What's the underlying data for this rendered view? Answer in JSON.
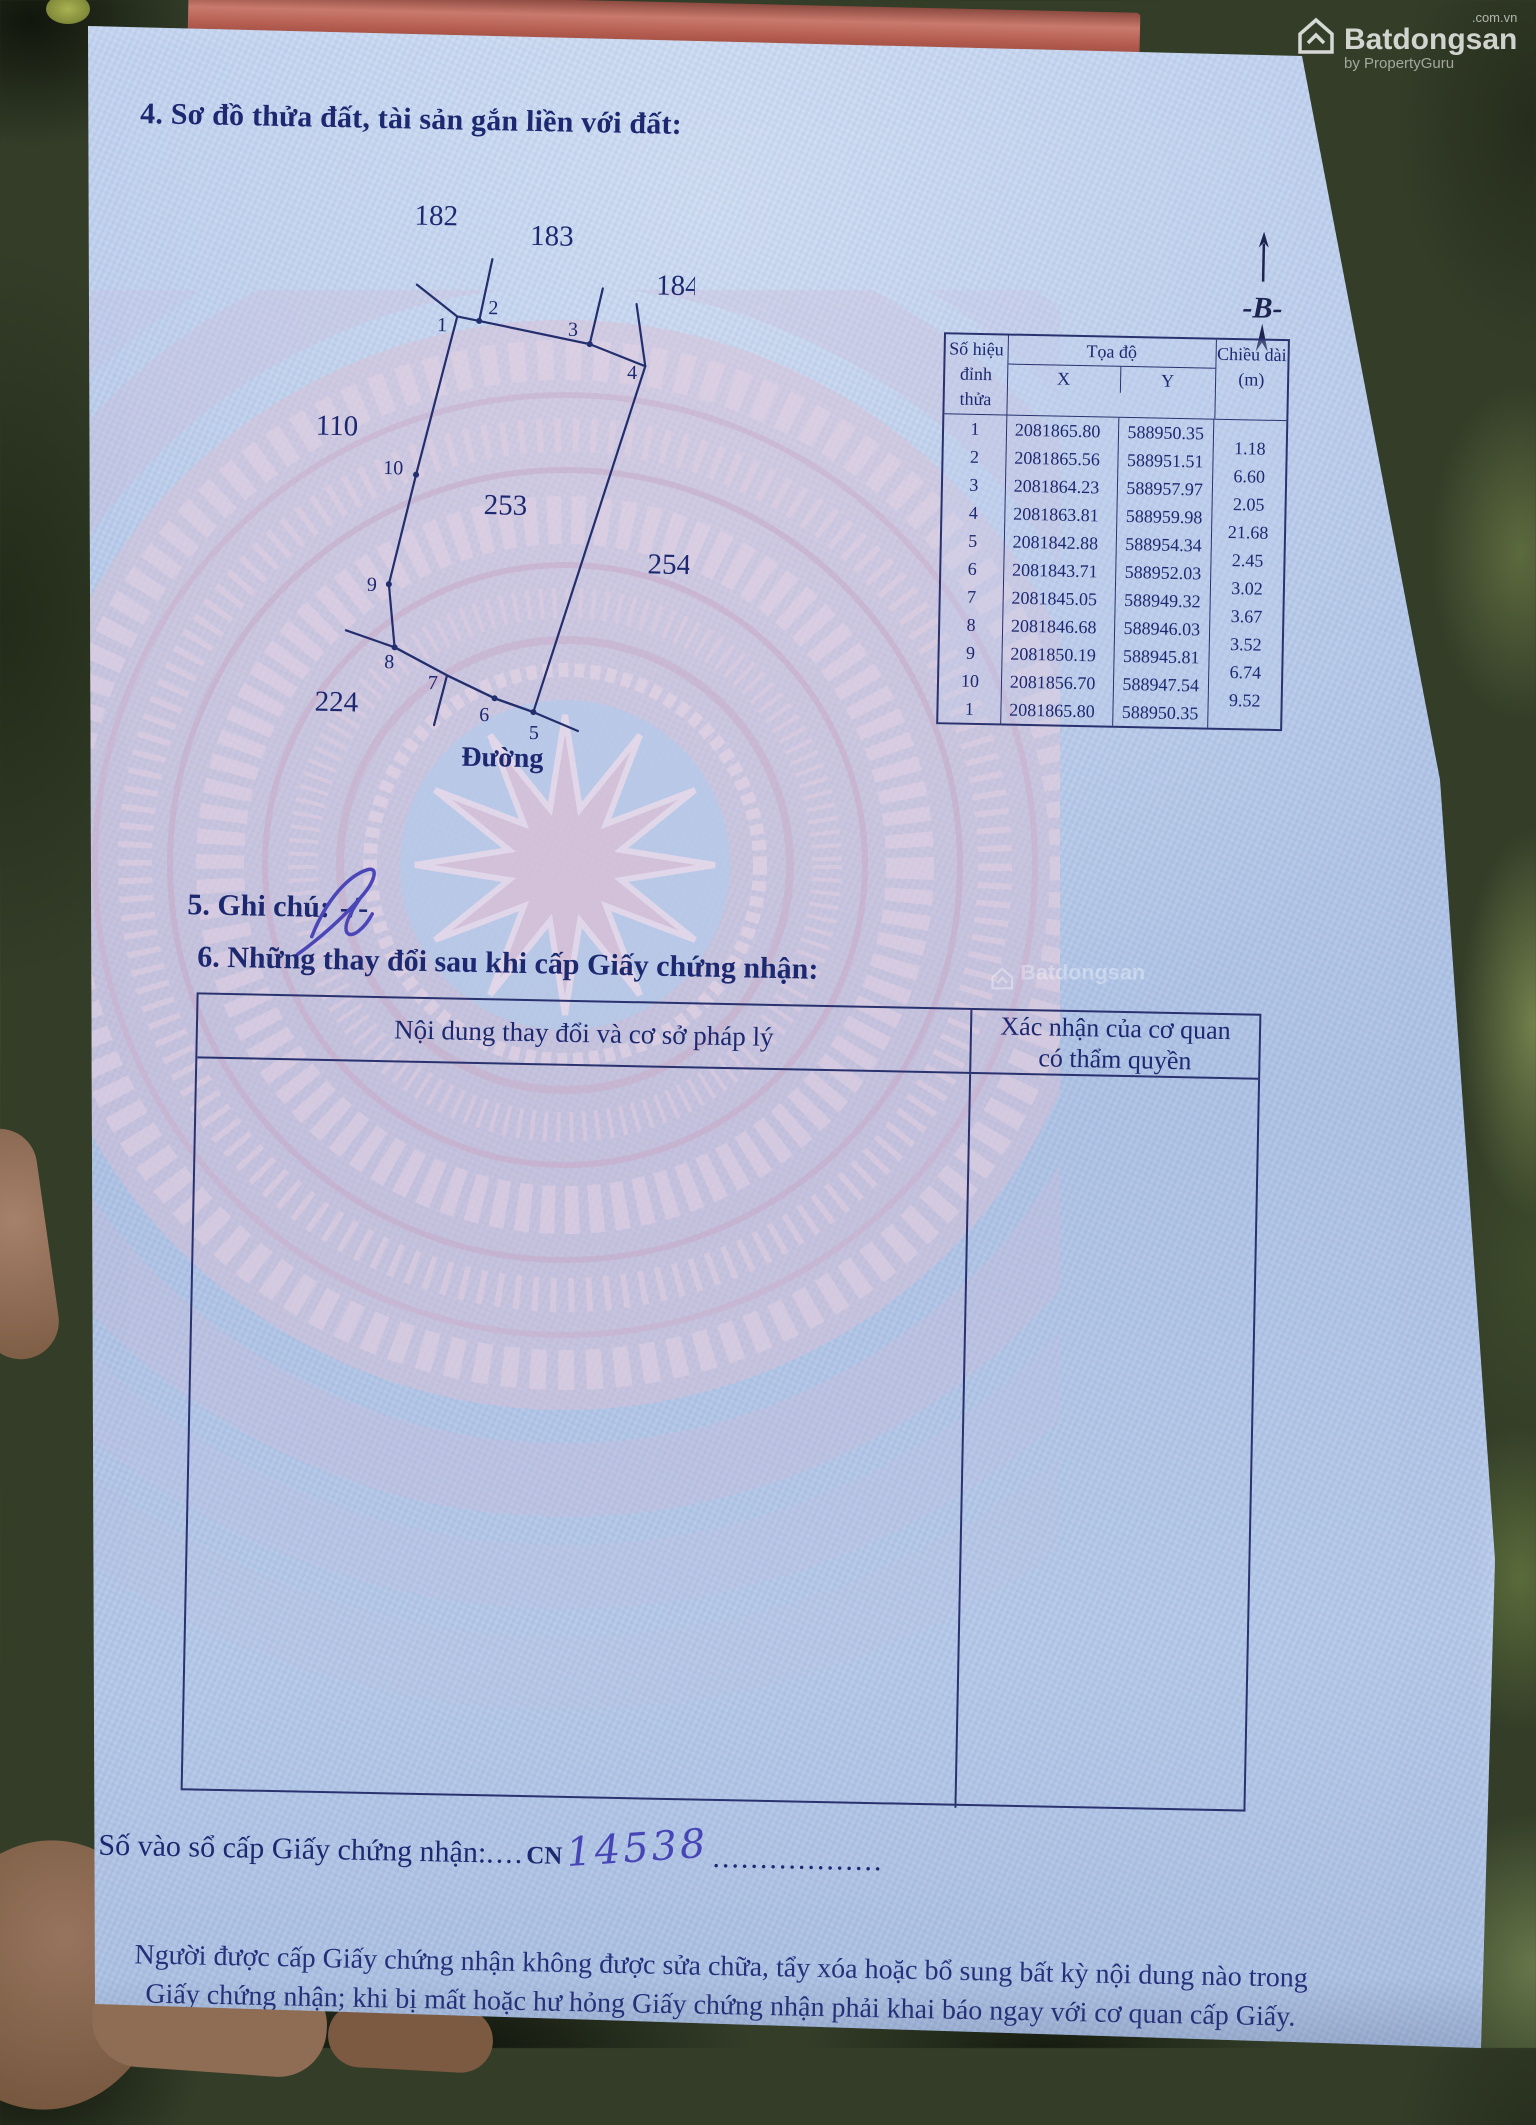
{
  "photo_watermark": {
    "brand": "Batdongsan",
    "domain_suffix": ".com.vn",
    "byline": "by PropertyGuru",
    "center_brand": "Batdongsan"
  },
  "section4": {
    "title": "4. Sơ đồ thửa đất, tài sản gắn liền với đất:"
  },
  "diagram": {
    "parcel_labels": [
      "182",
      "183",
      "184",
      "110",
      "253",
      "254",
      "224"
    ],
    "vertex_labels": [
      "1",
      "2",
      "3",
      "4",
      "5",
      "6",
      "7",
      "8",
      "9",
      "10"
    ],
    "road_label": "Đường",
    "north_label": "-B-"
  },
  "coord_table": {
    "header": {
      "col_vertex_line1": "Số hiệu",
      "col_vertex_line2": "đỉnh thửa",
      "col_coords": "Tọa độ",
      "col_x": "X",
      "col_y": "Y",
      "col_length_line1": "Chiều dài",
      "col_length_line2": "(m)"
    },
    "rows": [
      {
        "id": "1",
        "x": "2081865.80",
        "y": "588950.35"
      },
      {
        "id": "2",
        "x": "2081865.56",
        "y": "588951.51"
      },
      {
        "id": "3",
        "x": "2081864.23",
        "y": "588957.97"
      },
      {
        "id": "4",
        "x": "2081863.81",
        "y": "588959.98"
      },
      {
        "id": "5",
        "x": "2081842.88",
        "y": "588954.34"
      },
      {
        "id": "6",
        "x": "2081843.71",
        "y": "588952.03"
      },
      {
        "id": "7",
        "x": "2081845.05",
        "y": "588949.32"
      },
      {
        "id": "8",
        "x": "2081846.68",
        "y": "588946.03"
      },
      {
        "id": "9",
        "x": "2081850.19",
        "y": "588945.81"
      },
      {
        "id": "10",
        "x": "2081856.70",
        "y": "588947.54"
      },
      {
        "id": "1",
        "x": "2081865.80",
        "y": "588950.35"
      }
    ],
    "edge_lengths": [
      "1.18",
      "6.60",
      "2.05",
      "21.68",
      "2.45",
      "3.02",
      "3.67",
      "3.52",
      "6.74",
      "9.52"
    ]
  },
  "section5": {
    "label": "5. Ghi chú:",
    "value": "-/-"
  },
  "section6": {
    "title": "6. Những thay đổi sau khi cấp Giấy chứng nhận:",
    "col1_header": "Nội dung thay đổi và cơ sở pháp lý",
    "col2_header_line1": "Xác nhận của cơ quan",
    "col2_header_line2": "có thẩm quyền"
  },
  "footer": {
    "registry_label": "Số vào sổ cấp Giấy chứng nhận:",
    "registry_dots": "....",
    "registry_prefix": "CN",
    "registry_number_handwritten": "14538",
    "trailing_dots": "..................",
    "notice_line1": "Người được cấp Giấy chứng nhận không được sửa chữa, tẩy xóa hoặc bổ sung bất kỳ nội dung nào trong",
    "notice_line2": "Giấy chứng nhận; khi bị mất hoặc hư hỏng Giấy chứng nhận phải khai báo ngay với cơ quan cấp Giấy."
  }
}
